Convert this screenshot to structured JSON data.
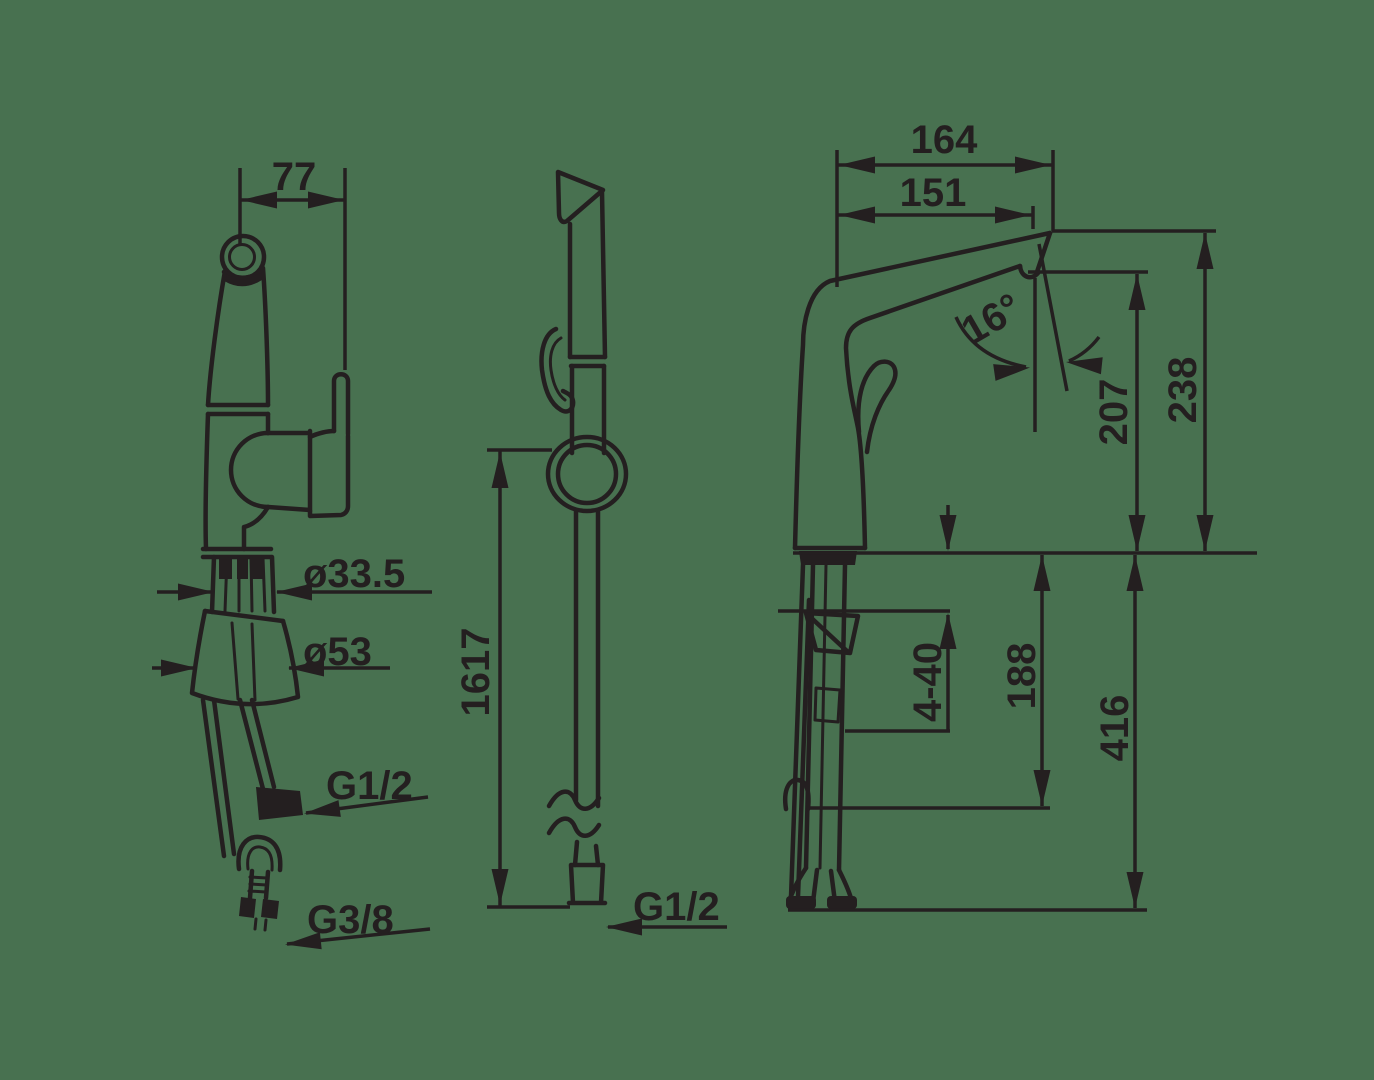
{
  "colors": {
    "background": "#487150",
    "line": "#241F20"
  },
  "views": {
    "left_view": {
      "dim_width": "77",
      "dia_shank": "ø33.5",
      "dia_base": "ø53",
      "hose_thread": "G1/2",
      "supply_thread": "G3/8"
    },
    "middle_view": {
      "hose_length": "1617",
      "hose_thread": "G1/2"
    },
    "right_view": {
      "dim_reach_total": "164",
      "dim_reach_spout": "151",
      "dim_angle": "16°",
      "dim_height_outlet": "207",
      "dim_height_top": "238",
      "dim_deck_range": "4-40",
      "dim_under_hose": "188",
      "dim_under_total": "416"
    }
  }
}
